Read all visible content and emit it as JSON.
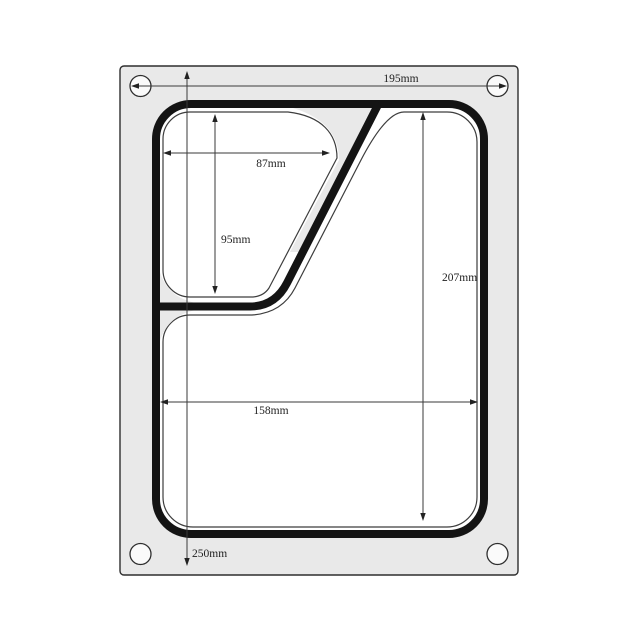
{
  "labels": {
    "plate_width": "195mm",
    "small_comp_width": "87mm",
    "small_comp_height": "95mm",
    "large_comp_height": "207mm",
    "large_comp_width": "158mm",
    "plate_height": "250mm"
  },
  "colors": {
    "background": "#ffffff",
    "plate": "#e9e9e9",
    "plate_border": "#2e2e2e",
    "hole_fill": "#fafafa",
    "hole_border": "#2e2e2e",
    "seal_contour": "#141414",
    "compartment_outline": "#3d3d3d",
    "compartment_fill": "#ffffff",
    "dimension_line": "#3a3a3a",
    "text": "#1f1f1f"
  }
}
